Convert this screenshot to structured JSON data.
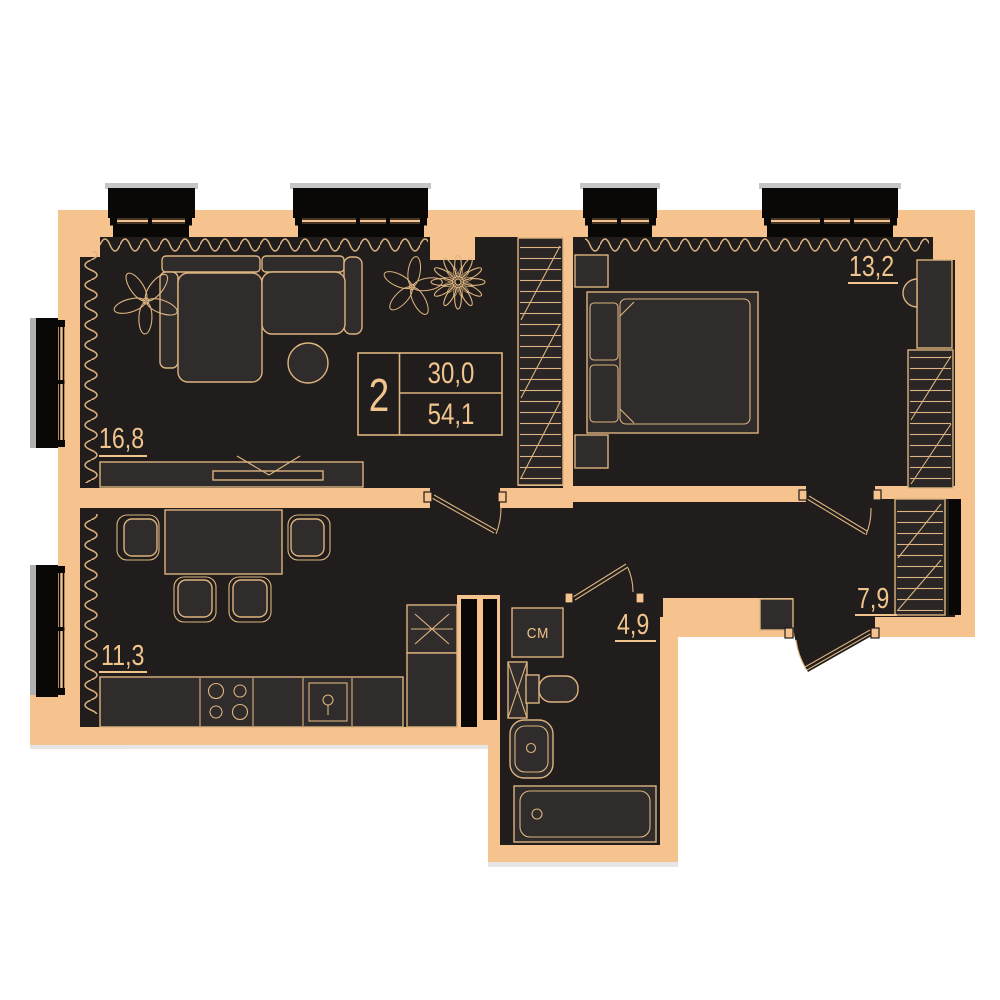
{
  "info_box": {
    "rooms_count": "2",
    "living_area": "30,0",
    "total_area": "54,1"
  },
  "rooms": {
    "living": {
      "area": "16,8"
    },
    "kitchen": {
      "area": "11,3"
    },
    "bedroom": {
      "area": "13,2"
    },
    "hallway": {
      "area": "7,9"
    },
    "bathroom": {
      "area": "4,9"
    }
  },
  "appliances": {
    "washing_machine": "СМ"
  },
  "colors": {
    "bg": "#ffffff",
    "wall": "#f6c28e",
    "floor": "#201d1c",
    "furn": "#2f2c2b",
    "furnD": "#292625",
    "line": "#ddb47f",
    "label": "#f0c48c",
    "black": "#0a0807",
    "grayD": "#7d7d7d",
    "grayM": "#9e9e9e",
    "grayL": "#d5d5d5"
  }
}
